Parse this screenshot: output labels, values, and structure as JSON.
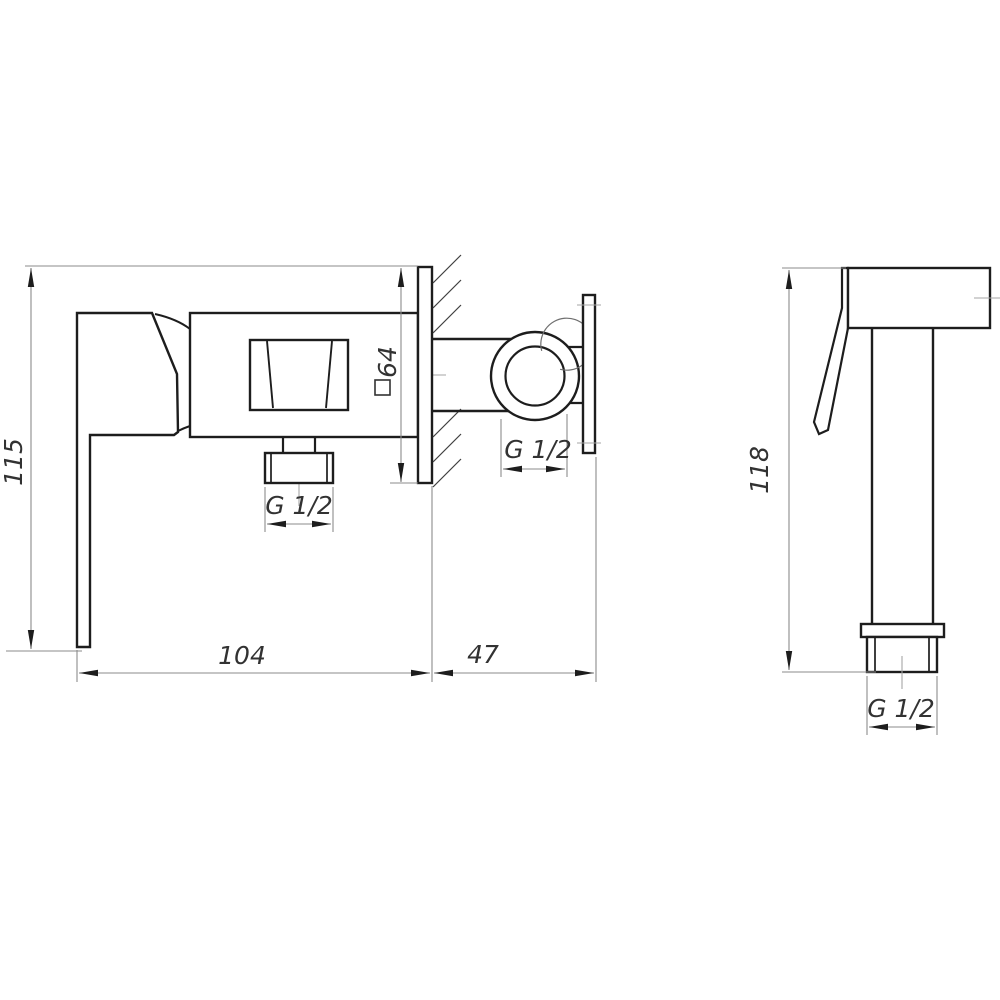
{
  "drawing": {
    "kind": "technical-drawing",
    "subject": "wall-mounted bidet mixer with hand shower, two side views",
    "outline_color": "#1d1d1d",
    "dimension_line_color": "#8b8b8b",
    "background_color": "#ffffff"
  },
  "mixer_view": {
    "height_dim": "115",
    "width_dim": "104",
    "wall_offset_dim": "47",
    "wall_plate_square_dim": "64",
    "outlet_thread_label": "G 1/2",
    "wall_connection_thread_label": "G 1/2"
  },
  "shower_view": {
    "height_dim": "118",
    "inlet_thread_label": "G 1/2"
  }
}
